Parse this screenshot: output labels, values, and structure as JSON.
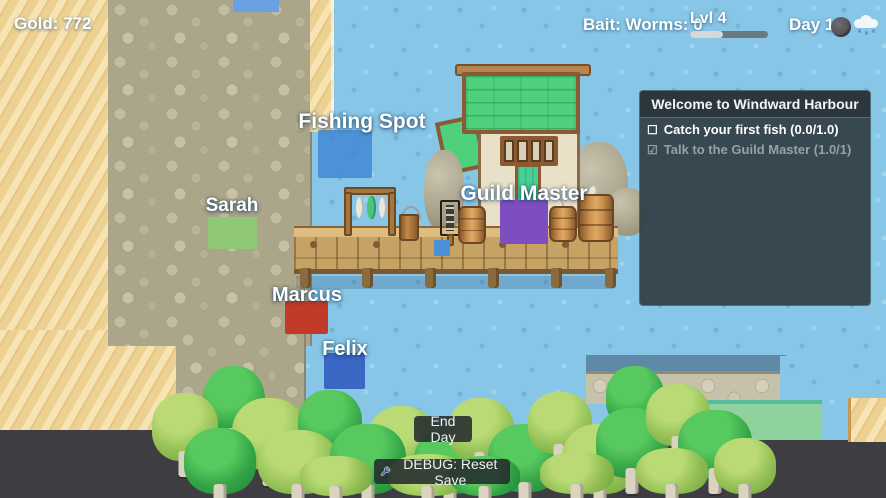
{
  "hud": {
    "gold": "Gold: 772",
    "bait": "Bait: Worms: 0",
    "level": "Lvl 4",
    "level_progress_pct": 42,
    "day": "Day 1"
  },
  "quest_panel": {
    "title": "Welcome to Windward Harbour",
    "quests": [
      {
        "checkbox": "☐",
        "label": "Catch your first fish (0.0/1.0)",
        "completed": false
      },
      {
        "checkbox": "☑",
        "label": "Talk to the Guild Master (1.0/1)",
        "completed": true
      }
    ]
  },
  "map_labels": {
    "fishing_spot": "Fishing Spot",
    "sarah": "Sarah",
    "guild_master": "Guild Master",
    "marcus": "Marcus",
    "felix": "Felix"
  },
  "buttons": {
    "end_day": "End Day",
    "debug_reset": "DEBUG: Reset Save"
  },
  "colors": {
    "fishing_spot_marker": "#3f86d2",
    "player_marker": "#4a90d9",
    "sarah_marker": "#8fc978",
    "guild_master_marker": "#7d4ec0",
    "marcus_marker": "#c23b28",
    "felix_marker": "#3a66c4",
    "xp_track": "#68797f",
    "xp_fill": "#d7d7d7"
  }
}
